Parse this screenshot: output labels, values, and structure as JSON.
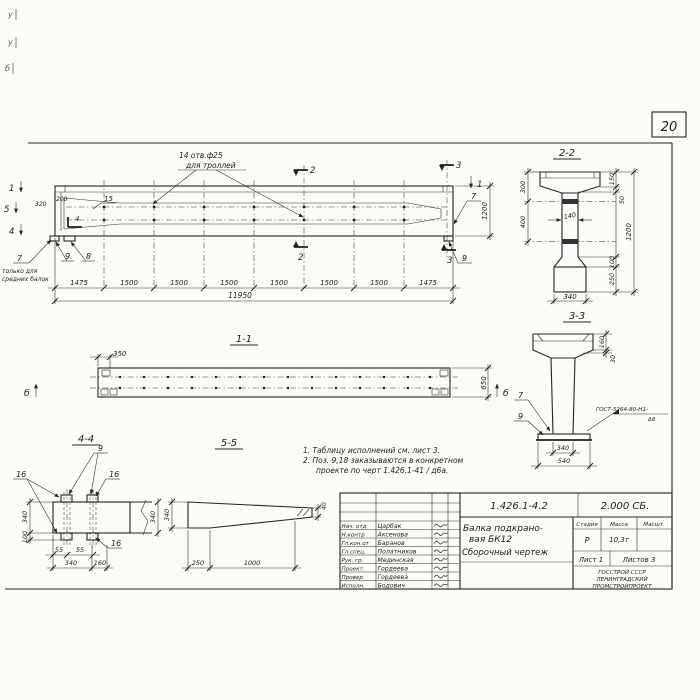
{
  "page": {
    "sheet_number": "20",
    "corner_marks": [
      "у",
      "у",
      "б"
    ]
  },
  "callouts": {
    "c7": "7",
    "c8": "8",
    "c9": "9",
    "c15": "15",
    "c16": "16"
  },
  "markers": {
    "m1": "1",
    "m2": "2",
    "m3": "3",
    "m4": "4",
    "m5": "5",
    "mb": "б"
  },
  "main_view": {
    "trolley_note_line1": "14 отв.ф25",
    "trolley_note_line2": "для троллей",
    "note_only_line1": "только для",
    "note_only_line2": "средних балок",
    "dims": {
      "d320": "320",
      "d200": "200",
      "d1475": "1475",
      "d1500": "1500",
      "total": "11950",
      "height": "1200"
    }
  },
  "section_1_1": {
    "title": "1-1",
    "dims": {
      "d350": "350",
      "d650": "650"
    }
  },
  "section_2_2": {
    "title": "2-2",
    "dims": {
      "d300": "300",
      "d400": "400",
      "d140": "140",
      "d150": "150",
      "d50": "50",
      "d1200": "1200",
      "d100": "100",
      "d250": "250",
      "d340": "340"
    }
  },
  "section_3_3": {
    "title": "3-3",
    "dims": {
      "d160": "160",
      "d30": "30",
      "d340": "340",
      "d540": "540"
    },
    "weld_note_line1": "ГОСТ-5264-80-Н1-",
    "weld_note_line2": "Δ6"
  },
  "section_4_4": {
    "title": "4-4",
    "dims": {
      "d340_left": "340",
      "d100": "100",
      "d340_right": "340",
      "d55_1": "55",
      "d55_2": "55",
      "d340_bottom": "340",
      "d160": "160"
    }
  },
  "section_5_5": {
    "title": "5-5",
    "dims": {
      "d340": "340",
      "d250": "250",
      "d1000": "1000",
      "d40": "40"
    }
  },
  "notes": {
    "line1": "1. Таблицу исполнений см. лист 3.",
    "line2": "2. Поз. 9,18 заказываются в конкретном",
    "line3": "проекте по черт 1.426.1-41 / д6а."
  },
  "title_block": {
    "doc_number": "1.426.1-4.2",
    "doc_code": "2.000 СБ.",
    "title_line1": "Балка подкрано-",
    "title_line2": "вая БК12",
    "title_line3": "Сборочный чертеж",
    "stage_label": "Стадия",
    "mass_label": "Масса",
    "scale_label": "Масшт.",
    "stage_value": "Р",
    "mass_value": "10,3т",
    "sheet_info": "Лист 1",
    "sheets_info": "Листов 3",
    "org_line1": "ГОССТРОЙ СССР",
    "org_line2": "ЛЕНИНГРАДСКИЙ",
    "org_line3": "ПРОМСТРОЙПРОЕКТ",
    "staff": [
      {
        "role": "Нач. отд",
        "name": "Царбак"
      },
      {
        "role": "Н.контр",
        "name": "Аксенова"
      },
      {
        "role": "Гл.кон.от",
        "name": "Баранов"
      },
      {
        "role": "Гл.спец.",
        "name": "Полатников"
      },
      {
        "role": "Рук. гр.",
        "name": "Мединская"
      },
      {
        "role": "Проект.",
        "name": "Гордеева"
      },
      {
        "role": "Провер.",
        "name": "Гордеева"
      },
      {
        "role": "Исполн.",
        "name": "Бодович"
      }
    ]
  }
}
